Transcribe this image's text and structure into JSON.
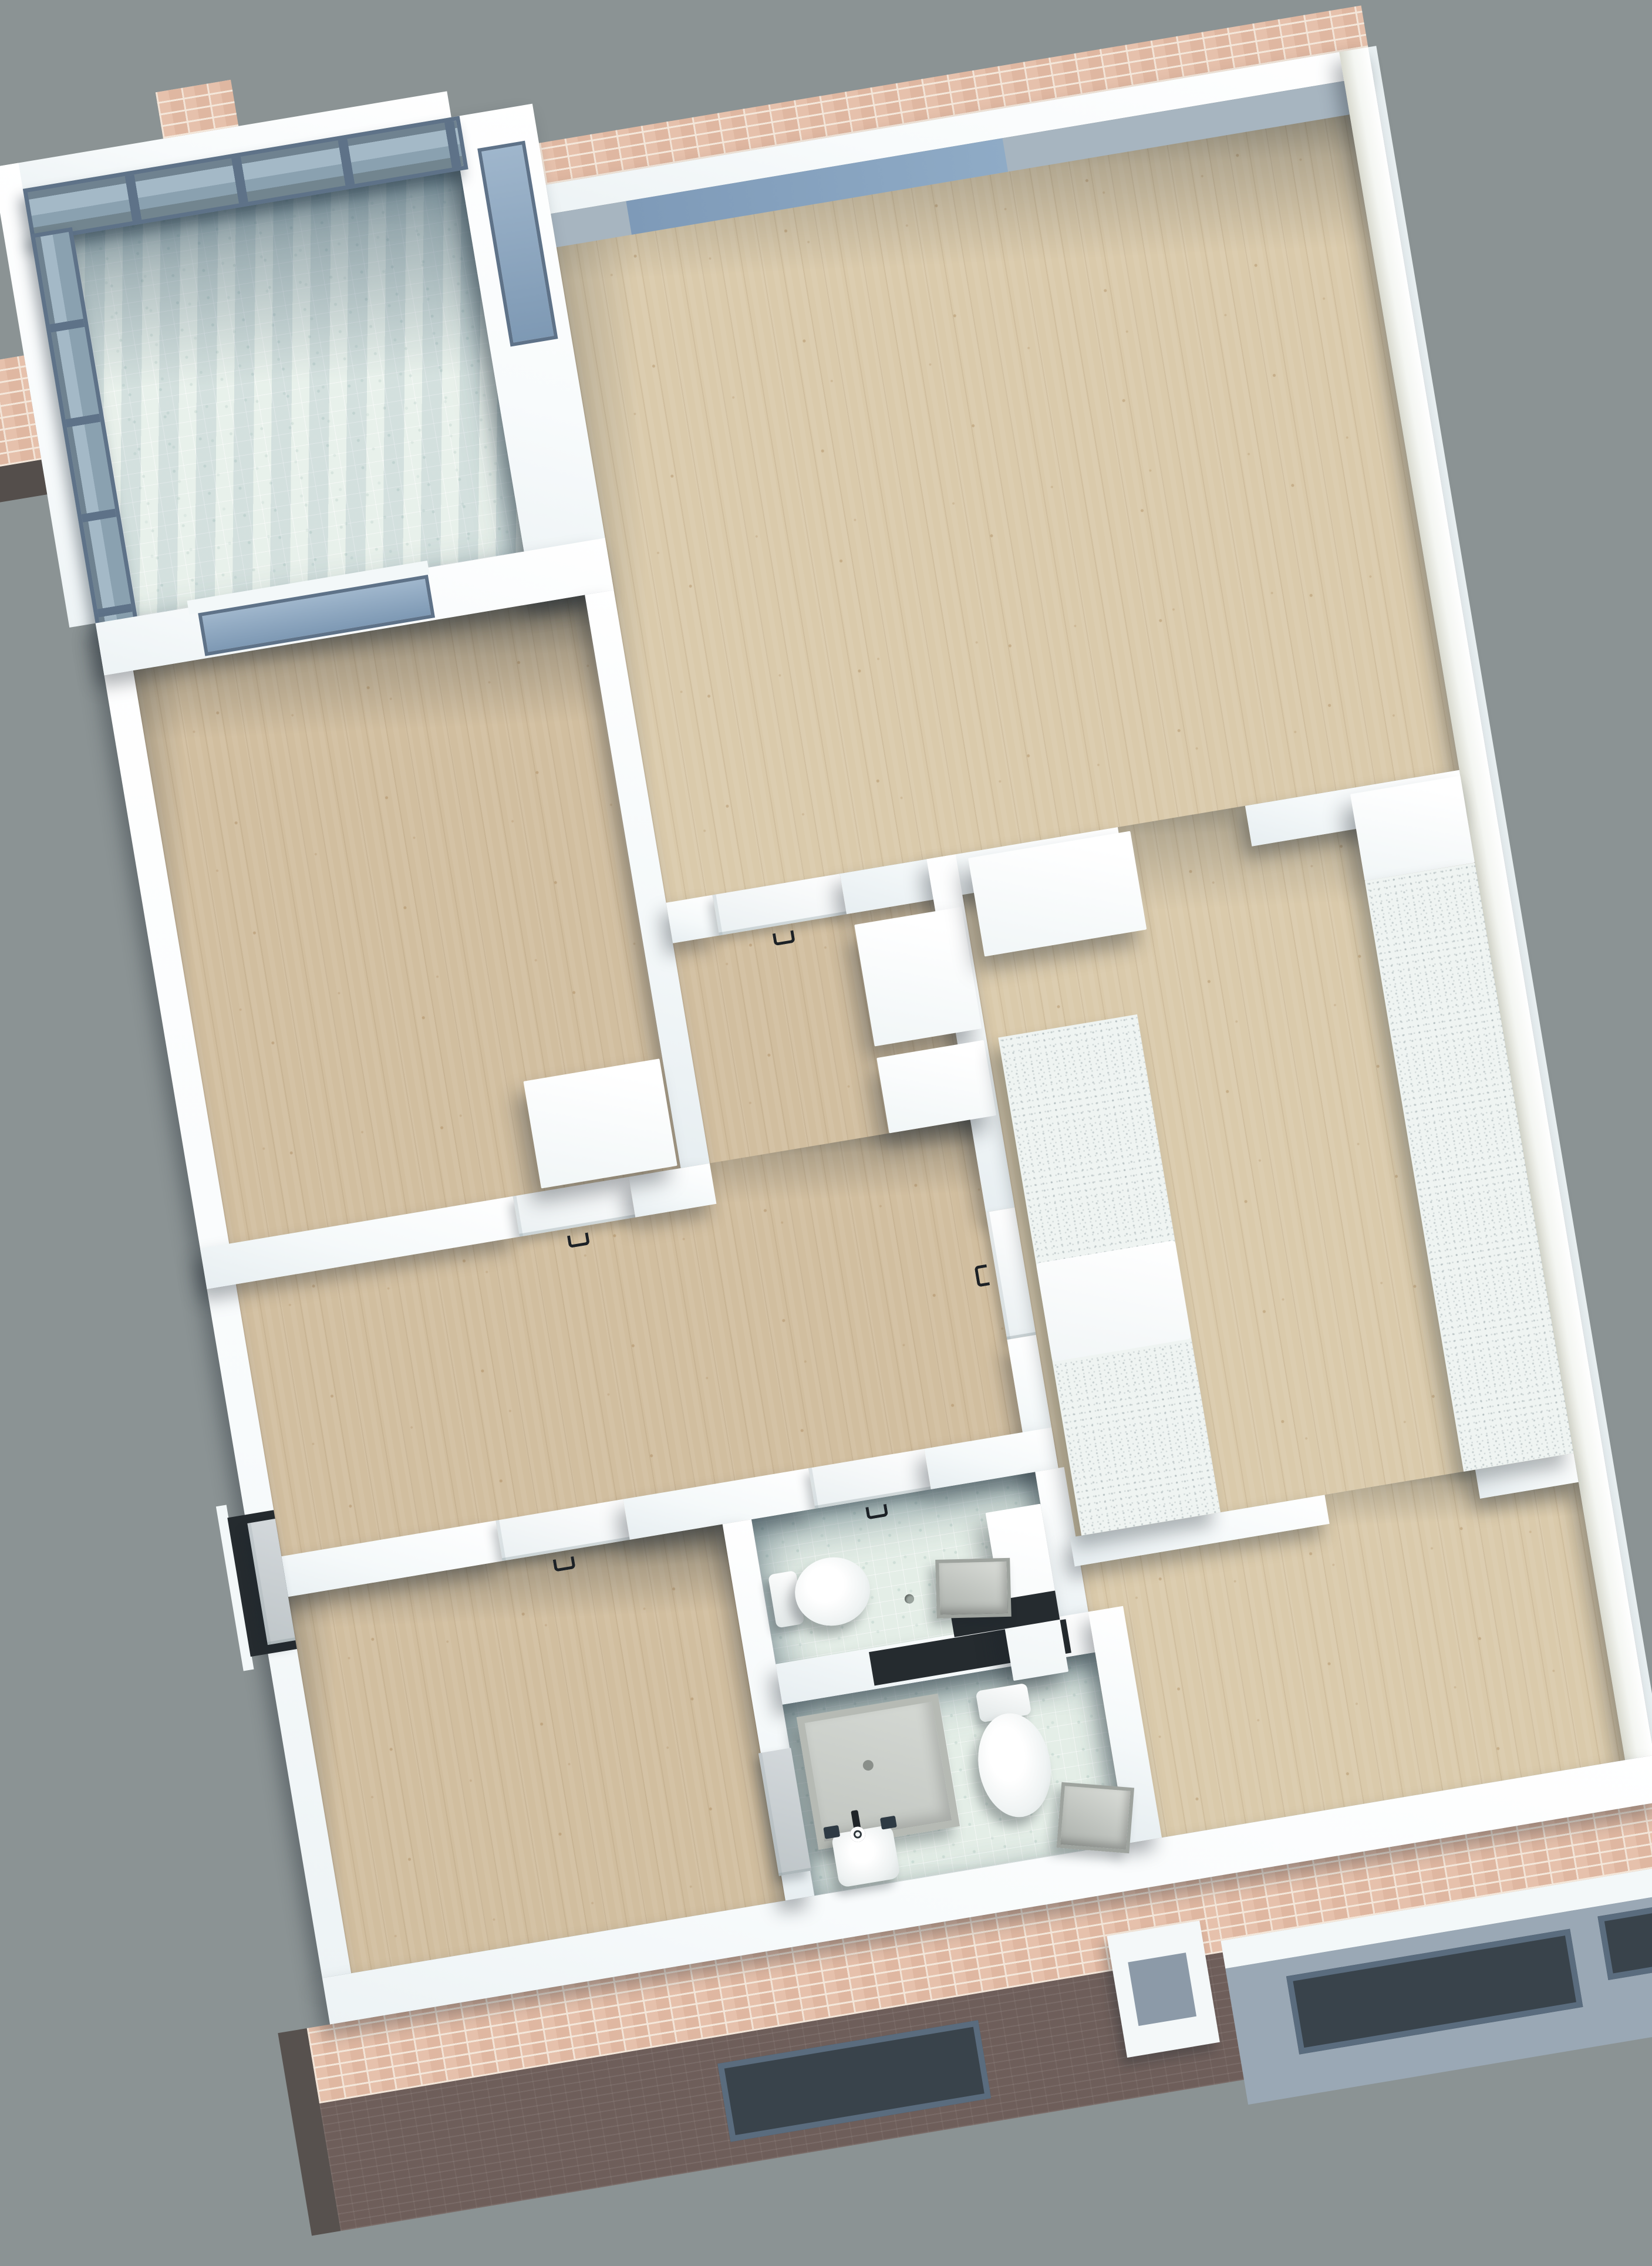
{
  "meta": {
    "type": "3d-architectural-floor-plan-rendering",
    "view": "top-down axonometric, apartment plan rotated about 9.5 degrees counterclockwise",
    "background": "plain gray, no text or UI controls visible"
  },
  "colors": {
    "bg": "#8B9394",
    "wood": "#DACAAB",
    "wood2": "#D1BE9F",
    "tile": "#E4EEE7",
    "counter": "#EFF4F2",
    "brick": "#E6C1AC",
    "mortar": "#F4E7DA",
    "brickdark": "#6E5E5A",
    "frame": "#5E7288",
    "glass": "#9FB6CC",
    "facadegray": "#9AA8B5",
    "wallwhite": "#FFFFFF",
    "shadow": "#16202633"
  },
  "scene": {
    "rooms": [
      {
        "id": "balcony",
        "floor": "mint mosaic tile",
        "features": [
          "glass railing with slate mullions on two sides",
          "pink brick pier stubs",
          "white parapet walls"
        ]
      },
      {
        "id": "living-room",
        "floor": "light speckled wood",
        "features": [
          "blue window band in top wall",
          "pink brick parapet cap outside",
          "door to hallway",
          "open passage to kitchen"
        ]
      },
      {
        "id": "bedroom-top-left",
        "floor": "light speckled wood",
        "features": [
          "window to balcony",
          "white wardrobe",
          "white door with dark U handle"
        ]
      },
      {
        "id": "hallway",
        "floor": "light speckled wood",
        "features": [
          "two white cabinets",
          "entry door recess in left wall",
          "doors to rooms"
        ]
      },
      {
        "id": "kitchen",
        "floor": "light speckled wood",
        "features": [
          "speckled counter along right wall",
          "speckled island counter with white appliance gap",
          "tall white cabinets",
          "door to hallway"
        ]
      },
      {
        "id": "wc",
        "floor": "mint mosaic tile",
        "features": [
          "toilet with tank",
          "white vanity counter",
          "gray tray",
          "dark storage niche",
          "door with dark U handle"
        ]
      },
      {
        "id": "bathroom",
        "floor": "mint mosaic tile",
        "features": [
          "gray shower tray",
          "wash basin with black faucet",
          "toilet",
          "gray basket",
          "gray door leaf"
        ]
      },
      {
        "id": "bedroom-bottom-left",
        "floor": "light speckled wood",
        "features": [
          "door with dark U handle"
        ]
      },
      {
        "id": "bedroom-bottom-right",
        "floor": "light speckled wood",
        "features": [
          "open passage from kitchen"
        ]
      }
    ],
    "facade": {
      "top_edge": "pink running-bond brick parapet cap",
      "bottom_left_edge": "pink brick cap over dark brown brick face with one slate-framed window slot and dark corner cap",
      "bottom_right_edge": "pink brick cap, white band, blue-gray plaster face with two dark window slots and a white protruding window box",
      "left_edge": "white wall with recessed dark entry door"
    },
    "fixtures": [
      "wardrobe",
      "hall-cabinet",
      "hall-cabinet",
      "kitchen-tall-cabinet",
      "kitchen-wall-cabinet",
      "kitchen-counter-run",
      "kitchen-island-counter",
      "wc-toilet",
      "wc-vanity",
      "wc-tray",
      "shower-tray",
      "wash-basin",
      "faucet",
      "bath-toilet",
      "laundry-basket"
    ]
  }
}
